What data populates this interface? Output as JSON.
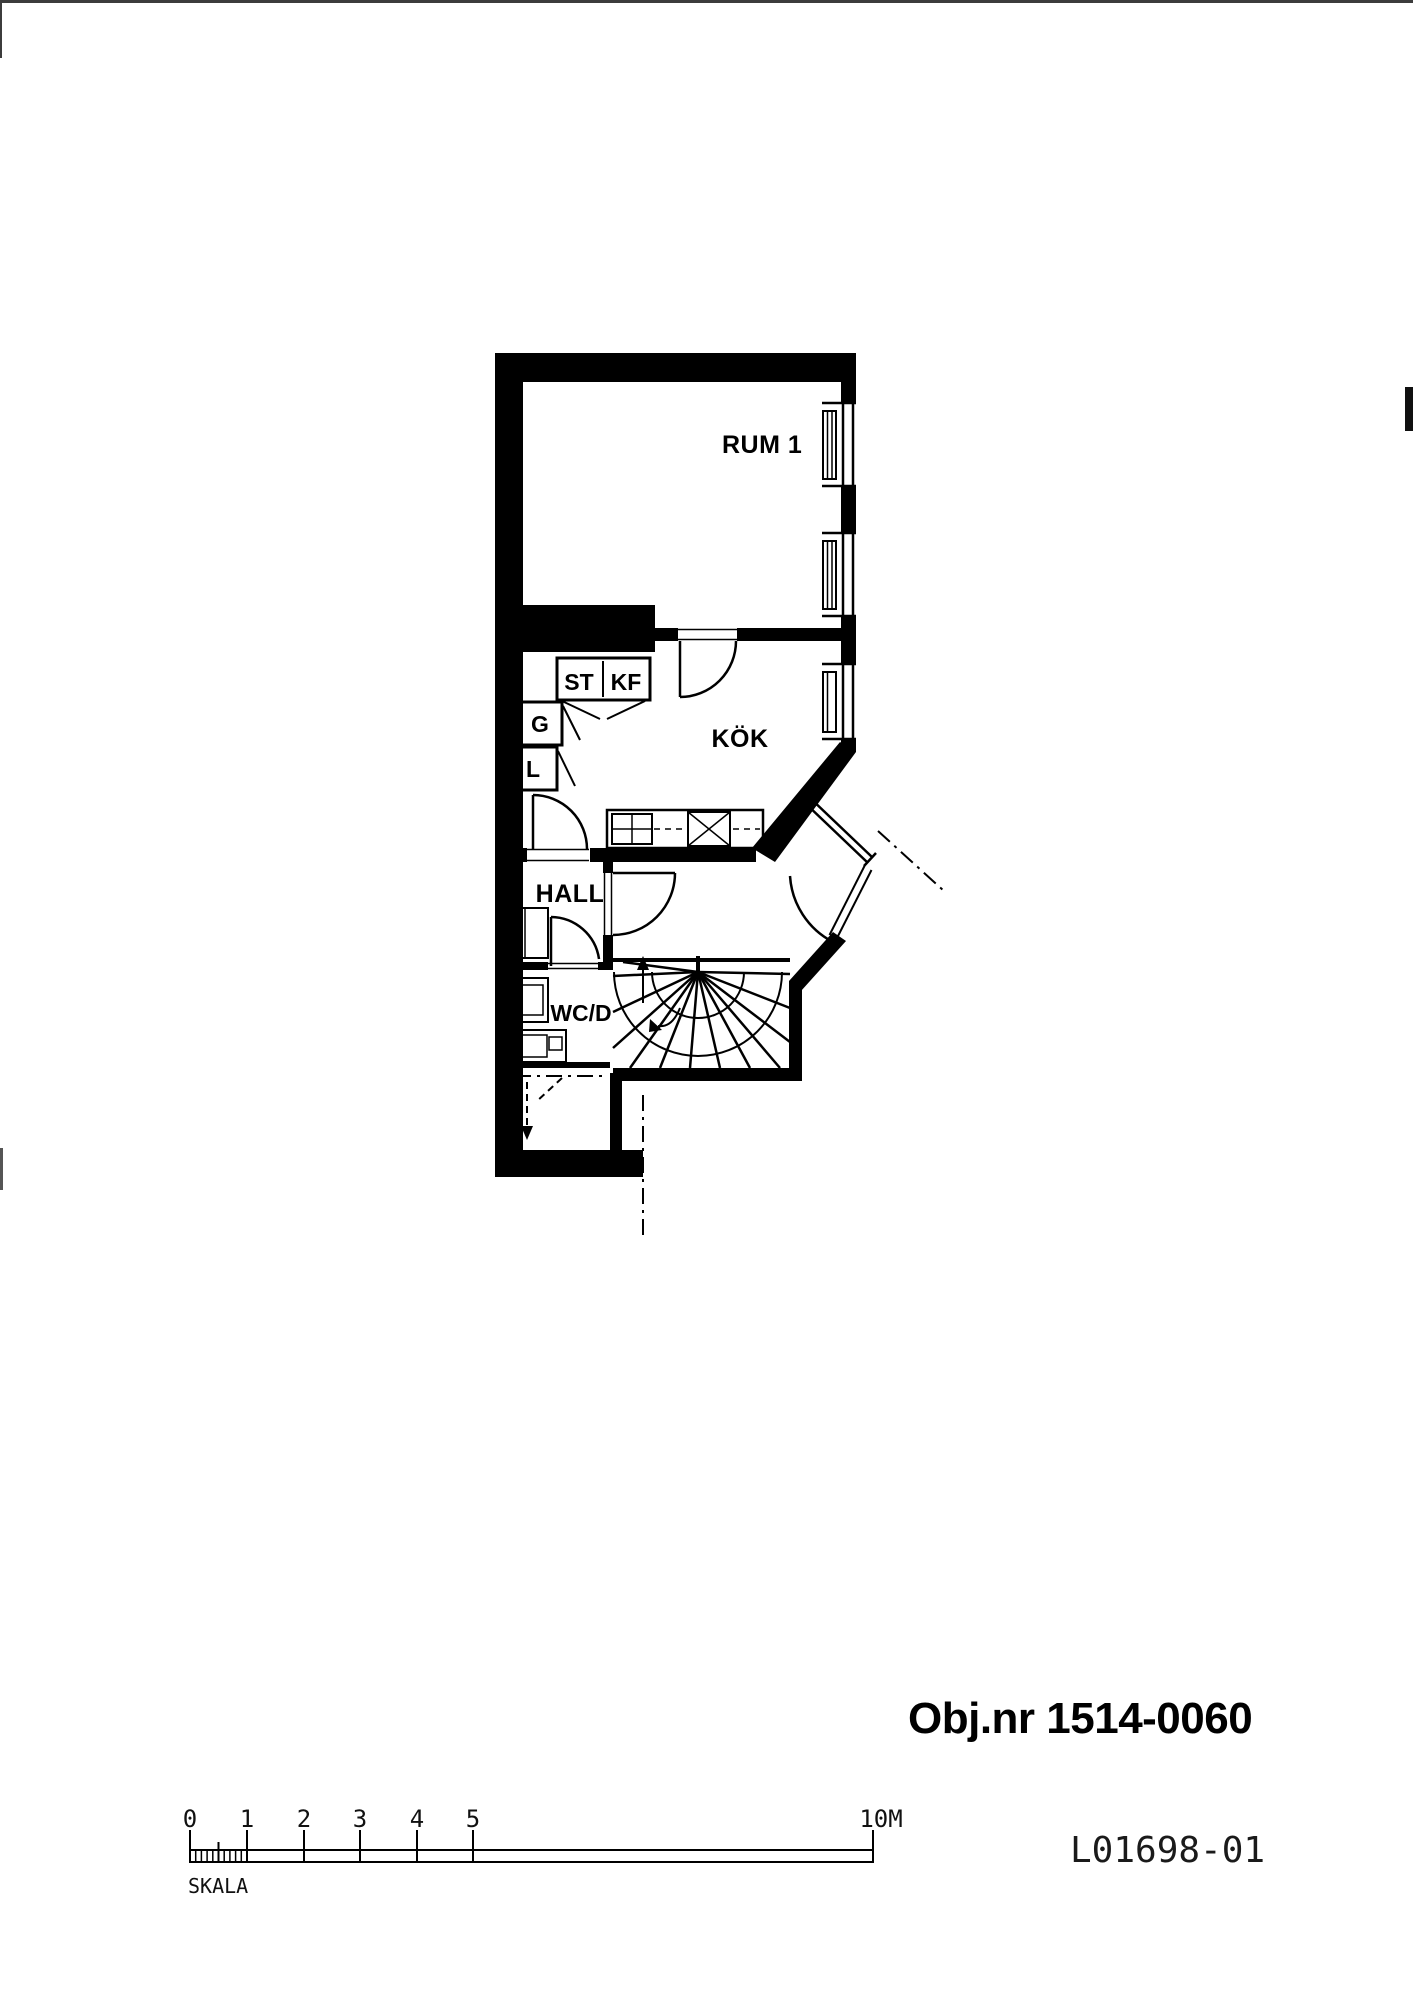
{
  "page": {
    "background": "#ffffff",
    "ink": "#000000"
  },
  "plan": {
    "rooms": {
      "rum1": "RUM 1",
      "kok": "KÖK",
      "hall": "HALL",
      "wcd": "WC/D"
    },
    "closets": {
      "st": "ST",
      "kf": "KF",
      "g": "G",
      "l": "L"
    }
  },
  "titles": {
    "object_number": "Obj.nr 1514-0060",
    "drawing_number": "L01698-01"
  },
  "scale_bar": {
    "label": "SKALA",
    "ticks": [
      "0",
      "1",
      "2",
      "3",
      "4",
      "5"
    ],
    "end_label": "10M"
  }
}
